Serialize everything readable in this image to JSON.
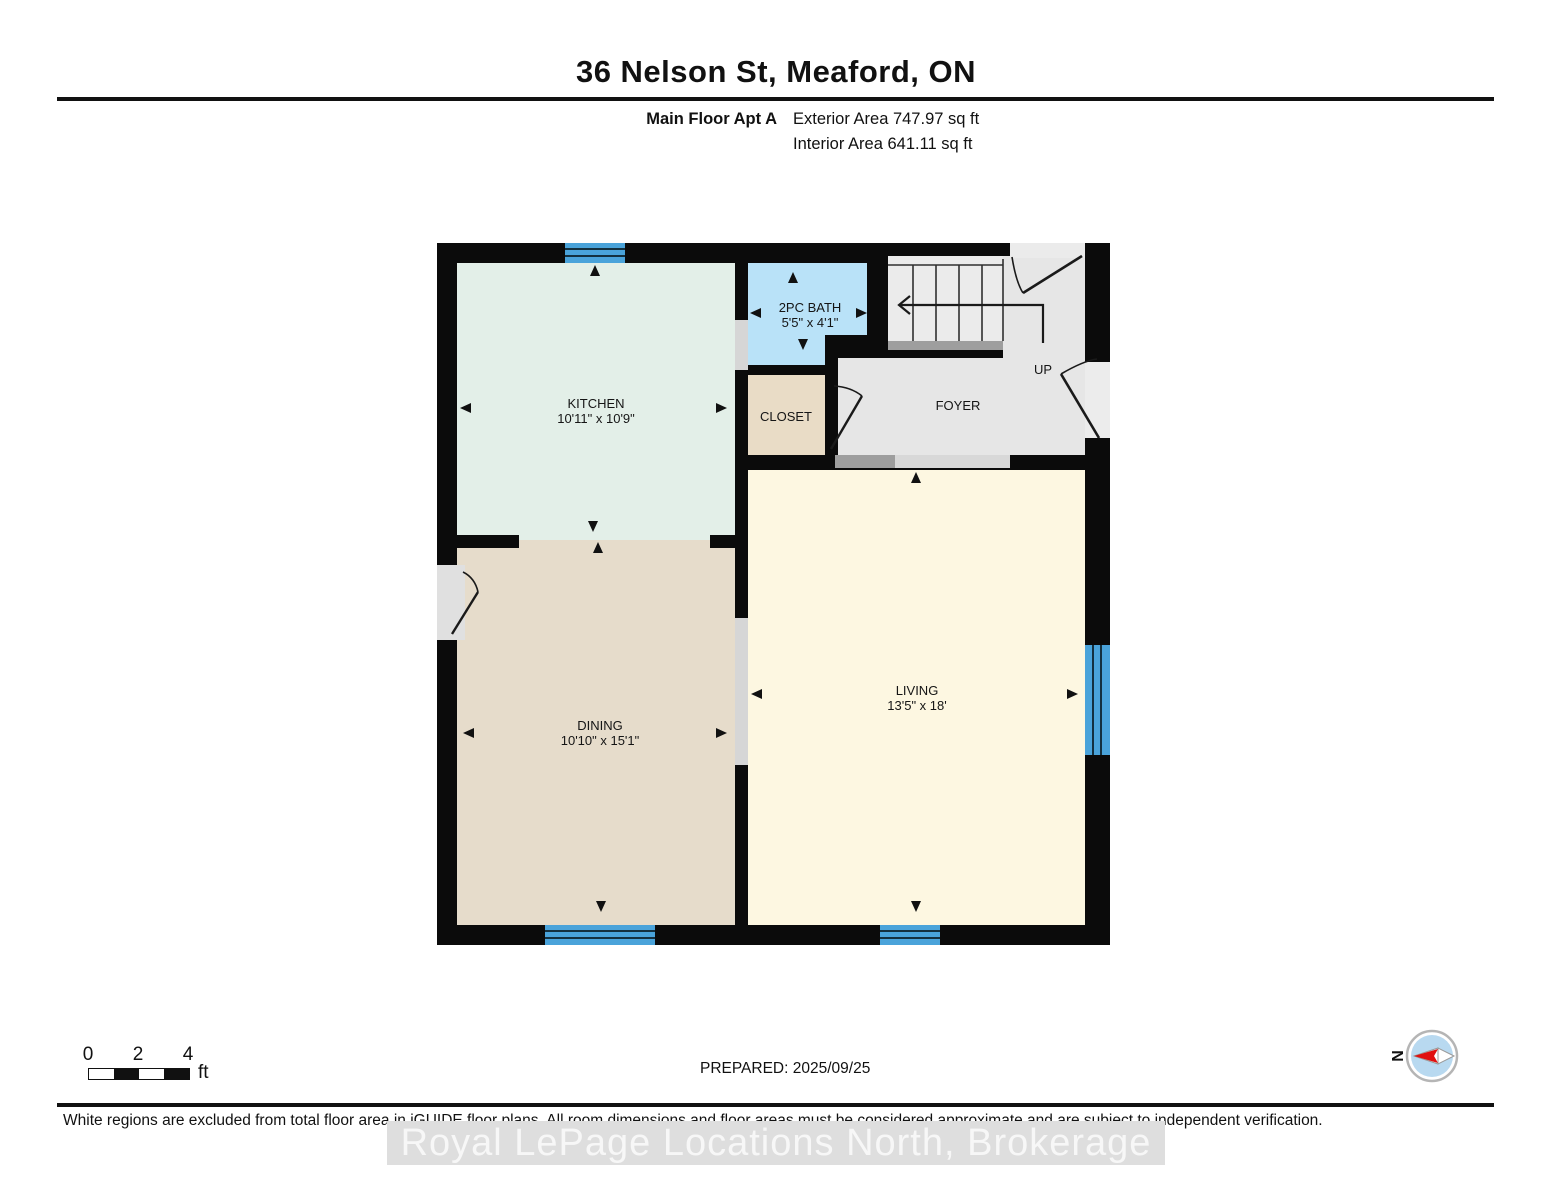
{
  "header": {
    "title": "36 Nelson St, Meaford, ON",
    "floor_label": "Main Floor Apt A",
    "exterior_area": "Exterior Area 747.97 sq ft",
    "interior_area": "Interior Area 641.11 sq ft"
  },
  "plan": {
    "rooms": {
      "kitchen": {
        "name": "KITCHEN",
        "dims": "10'11\" x 10'9\""
      },
      "bath": {
        "name": "2PC BATH",
        "dims": "5'5\" x 4'1\""
      },
      "closet": {
        "name": "CLOSET"
      },
      "foyer": {
        "name": "FOYER"
      },
      "stairs": {
        "label": "UP"
      },
      "dining": {
        "name": "DINING",
        "dims": "10'10\" x 15'1\""
      },
      "living": {
        "name": "LIVING",
        "dims": "13'5\" x 18'"
      }
    }
  },
  "scale_bar": {
    "tick_labels": [
      "0",
      "2",
      "4"
    ],
    "unit": "ft"
  },
  "footer": {
    "prepared": "PREPARED: 2025/09/25",
    "compass_label": "N",
    "disclaimer": "White regions are excluded from total floor area in iGUIDE floor plans. All room dimensions and floor areas must be considered approximate and are subject to independent verification.",
    "watermark": "Royal LePage Locations North, Brokerage"
  },
  "colors": {
    "wall": "#0b0b0b",
    "kitchen": "#e3efe8",
    "bath": "#b9e2f8",
    "closet": "#e9dcc6",
    "dining": "#e6dccb",
    "living": "#fdf7e1",
    "hall": "#e6e6e6",
    "hall_light": "#ebebeb",
    "window": "#4aa3da",
    "sill_dark": "#9e9e9e",
    "sill_light": "#d8d8d8",
    "opening": "#d6d6d6",
    "compass_blue": "#b8d9f0",
    "compass_red": "#e01010"
  }
}
